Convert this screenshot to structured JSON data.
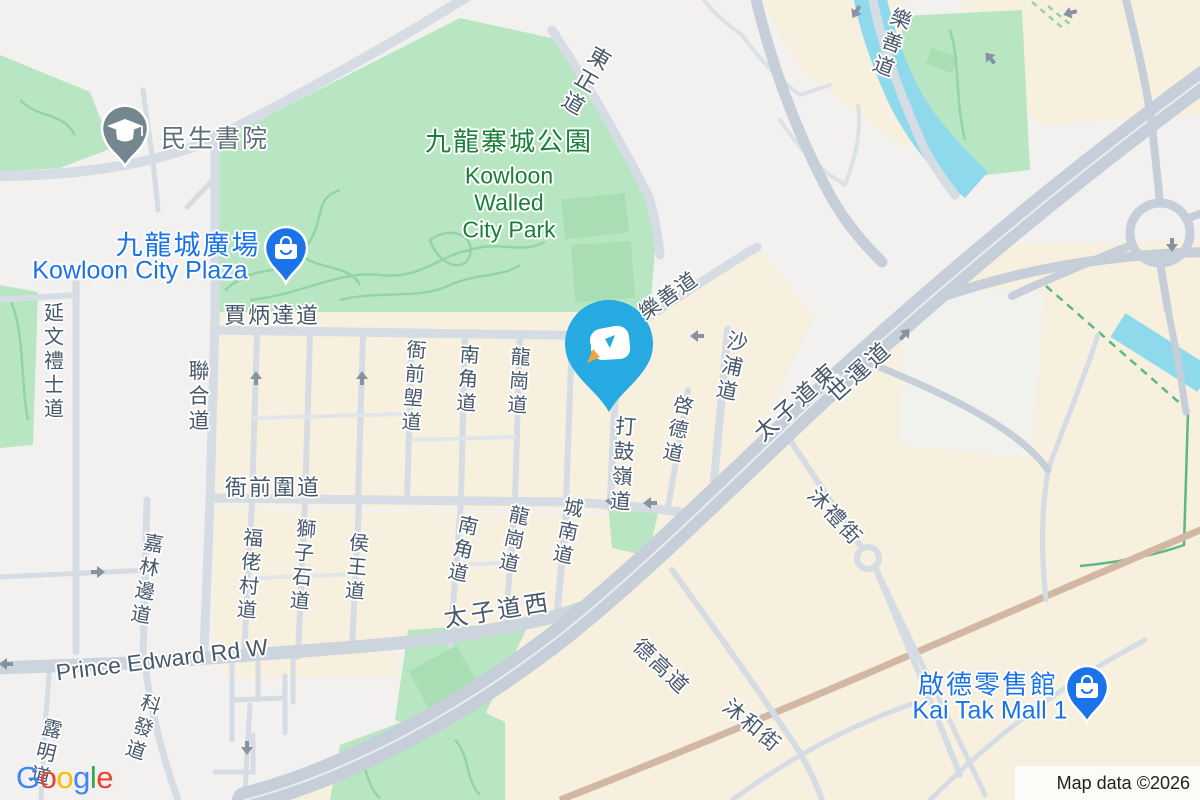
{
  "map": {
    "attribution": "Map data ©2026",
    "logo": {
      "letters": [
        "G",
        "o",
        "o",
        "g",
        "l",
        "e"
      ],
      "colors": [
        "#4285F4",
        "#EA4335",
        "#FBBC05",
        "#4285F4",
        "#34A853",
        "#EA4335"
      ]
    }
  },
  "pois": {
    "school": {
      "label": "民生書院"
    },
    "kowloon_city_plaza": {
      "label_zh": "九龍城廣場",
      "label_en": "Kowloon City Plaza"
    },
    "kai_tak_mall": {
      "label_zh": "啟德零售館",
      "label_en": "Kai Tak Mall 1"
    },
    "walled_city_park": {
      "label_zh": "九龍寨城公園",
      "label_en_line1": "Kowloon",
      "label_en_line2": "Walled",
      "label_en_line3": "City Park"
    }
  },
  "road_labels": [
    {
      "text": "東正道"
    },
    {
      "text": "樂善道"
    },
    {
      "text": "樂善道"
    },
    {
      "text": "賈炳達道"
    },
    {
      "text": "衙前圍道"
    },
    {
      "text": "延文禮士道"
    },
    {
      "text": "聯合道"
    },
    {
      "text": "嘉林邊道"
    },
    {
      "text": "衙前塱道"
    },
    {
      "text": "南角道"
    },
    {
      "text": "龍崗道"
    },
    {
      "text": "打鼓嶺道"
    },
    {
      "text": "啓德道"
    },
    {
      "text": "沙浦道"
    },
    {
      "text": "福佬村道"
    },
    {
      "text": "獅子石道"
    },
    {
      "text": "侯王道"
    },
    {
      "text": "南角道"
    },
    {
      "text": "龍崗道"
    },
    {
      "text": "城南道"
    },
    {
      "text": "太子道西"
    },
    {
      "text": "Prince Edward Rd W"
    },
    {
      "text": "太子道東"
    },
    {
      "text": "世運道"
    },
    {
      "text": "沐禮街"
    },
    {
      "text": "德高道"
    },
    {
      "text": "沐和街"
    },
    {
      "text": "科發道"
    },
    {
      "text": "露明道"
    }
  ],
  "colors": {
    "poi_blue": "#1a73e8",
    "park_green_label": "#188038",
    "road_label": "#48586b",
    "marker_blue": "#27aae1",
    "marker_accent_orange": "#f2a33c",
    "water": "#8ed9ec",
    "park_fill": "#b9e6c2",
    "building_beige": "#f7f0de",
    "school_pin_gray": "#76868f"
  }
}
